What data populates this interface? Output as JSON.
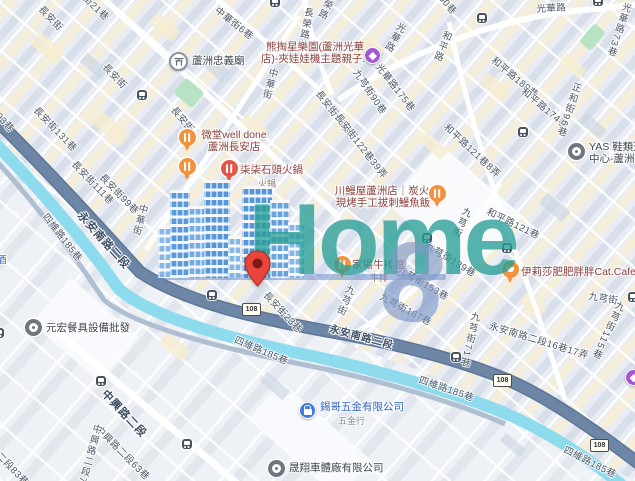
{
  "app": {
    "title": "Map of Luzhou District, New Taipei"
  },
  "watermark": {
    "logo_text": "Home",
    "logo_digit": "8"
  },
  "roads": {
    "shield": "108"
  },
  "colors": {
    "canal": "#8edbee",
    "main_road": "#6d86a5",
    "minor_road": "#ffffff",
    "land": "#e9edf3",
    "building_yellow": "#f6eccf",
    "watermark_teal": "rgba(40,158,150,0.78)",
    "watermark_building_blue": "#4a8fd7",
    "watermark_digit_blue": "rgba(128,152,198,0.66)",
    "pin_red": "#e8453c",
    "poi_food_orange": "#f0923e",
    "poi_hotpot_red": "#e25749",
    "poi_purple": "#a357d7",
    "poi_blue": "#3d79e0",
    "park_green": "#b7e3c3"
  },
  "streets": {
    "changan": "長安街",
    "changan193": "長安街193巷",
    "changan131": "長安街131巷",
    "changan111": "長安街111巷",
    "changan99": "長安街99巷",
    "changan73": "長安街73巷",
    "changan23": "長安街23巷",
    "changan68": "長安街68巷",
    "changan122": "長安街122巷39弄",
    "lane21": "街21巷",
    "zhonghua": "中華街",
    "zhonghua6": "中華街6巷",
    "changrong": "長榮路",
    "guanghua": "光華路",
    "guanghua175": "光華路175巷",
    "guanghua73": "光華路73巷",
    "guanghua150": "光華路150巷",
    "heping": "和平路",
    "heping188": "和平路188巷",
    "heping174": "和平路174巷",
    "heping121": "和平路121巷",
    "heping121_8": "和平路121巷8弄",
    "jiuqiong": "九芎街",
    "jiuqiong90": "九芎街90巷",
    "jiuqiong139": "九芎街139巷",
    "jiuqiong153": "九芎街153巷",
    "jiuqiong167": "九芎街167巷",
    "jiuqiong71": "九芎街71巷",
    "jiuqiong115": "九芎街115巷",
    "zhenghe96": "正和街96巷",
    "yongan": "永安南路二段",
    "yongan16": "永安南路二段16巷17弄",
    "siwei185": "四維路185巷",
    "zhongxing": "中興路二段",
    "zhongxing75": "中興路二段75巷",
    "zhongxing63": "中興路二段63巷",
    "zhongxing83": "中興路二段83巷",
    "jiu_partial": "酒"
  },
  "pois": {
    "temple": "蘆洲忠義廟",
    "claw_line1": "熊掏星樂園(蘆洲光華",
    "claw_line2": "店)-夾娃娃機主題親子...",
    "welldone_line1": "微堂well done",
    "welldone_line2": "蘆洲長安店",
    "hotpot": "柒柒石頭火鍋",
    "hotpot_sub": "火鍋",
    "eel_line1": "川鰻屋蘆洲店｜炭火",
    "eel_line2": "現烤手工拔刺鰻魚飯",
    "steak": "家場牛排館",
    "steak_sub": "牛排",
    "catcafe": "伊莉莎肥肥胖胖Cat.Cafe",
    "yas_line1": "YAS 鞋類選",
    "yas_line2": "中心-蘆洲",
    "tableware": "元宏餐具設備批發",
    "hardware": "錫哥五金有限公司",
    "hardware_sub": "五金行",
    "autobody": "晟翔車體廠有限公司"
  }
}
